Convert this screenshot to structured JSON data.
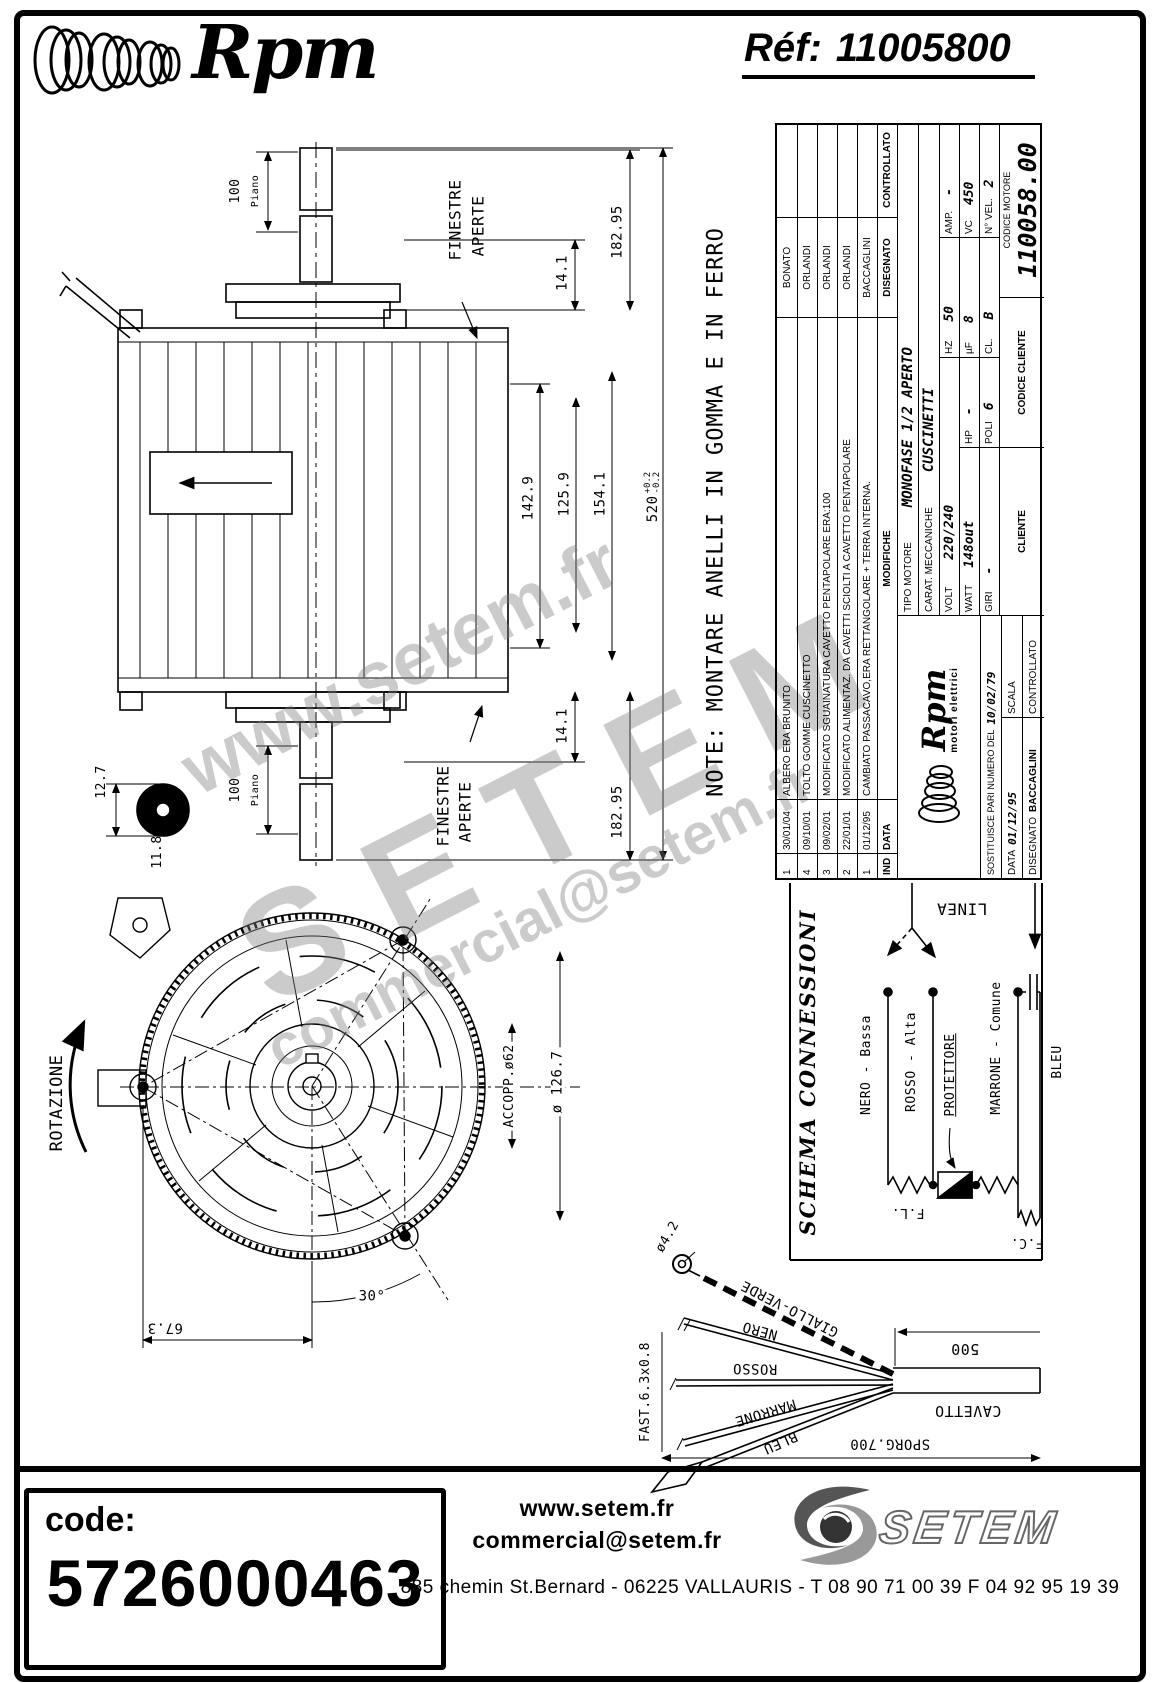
{
  "colors": {
    "ink": "#000000",
    "paper": "#ffffff",
    "watermark": "#7d7d7d"
  },
  "header": {
    "brand": "Rpm",
    "ref_label": "Réf:",
    "ref_number": "11005800"
  },
  "note": "NOTE: MONTARE ANELLI IN GOMMA E IN FERRO",
  "side_view": {
    "dim_100_top": "100",
    "piano_top": "Piano",
    "finestre_top_line1": "FINESTRE",
    "finestre_top_line2": "APERTE",
    "dim_14_1_top": "14.1",
    "dim_182_95_top": "182.95",
    "dim_142_9": "142.9",
    "dim_125_9": "125.9",
    "dim_154_1": "154.1",
    "dim_520": "520",
    "dim_520_tol_plus": "+0.2",
    "dim_520_tol_minus": "-0.2",
    "dim_14_1_bottom": "14.1",
    "dim_182_95_bottom": "182.95",
    "finestre_bottom_line1": "FINESTRE",
    "finestre_bottom_line2": "APERTE",
    "dim_100_bottom": "100",
    "piano_bottom": "Piano",
    "dim_12_7": "12.7",
    "dim_11_8": "11.8"
  },
  "front_view": {
    "rotazione": "ROTAZIONE",
    "accopp": "ACCOPP.ø62",
    "dia_126_7": "ø 126.7",
    "angle_30": "30°",
    "dim_67_3": "67.3"
  },
  "title_block": {
    "revisions": [
      {
        "ind": "1",
        "date": "30/01/04",
        "text": "ALBERO ERA BRUNITO",
        "name": "BONATO"
      },
      {
        "ind": "4",
        "date": "09/10/01",
        "text": "TOLTO GOMME CUSCINETTO",
        "name": "ORLANDI"
      },
      {
        "ind": "3",
        "date": "09/02/01",
        "text": "MODIFICATO SGUAINATURA CAVETTO PENTAPOLARE ERA:100",
        "name": "ORLANDI"
      },
      {
        "ind": "2",
        "date": "22/01/01",
        "text": "MODIFICATO ALIMENTAZ. DA CAVETTI SCIOLTI A CAVETTO PENTAPOLARE",
        "name": "ORLANDI"
      },
      {
        "ind": "1",
        "date": "01/12/95",
        "text": "CAMBIATO PASSACAVO,ERA RETTANGOLARE + TERRA INTERNA.",
        "name": "BACCAGLINI"
      }
    ],
    "rev_headers": {
      "ind": "IND",
      "data": "DATA",
      "modifiche": "MODIFICHE",
      "disegnato": "DISEGNATO",
      "controllato": "CONTROLLATO"
    },
    "tipo_motore_label": "TIPO MOTORE",
    "tipo_motore": "MONOFASE 1/2 APERTO",
    "carat_label": "CARAT. MECCANICHE",
    "carat": "CUSCINETTI",
    "specs": {
      "volt_label": "VOLT",
      "volt": "220/240",
      "hz_label": "HZ",
      "hz": "50",
      "amp_label": "AMP.",
      "amp": "-",
      "watt_label": "WATT",
      "watt": "148out",
      "hp_label": "HP",
      "hp": "-",
      "uf_label": "µF",
      "uf": "8",
      "vc_label": "VC",
      "vc": "450",
      "giri_label": "GIRI",
      "giri": "-",
      "poli_label": "POLI",
      "poli": "6",
      "cl_label": "CL.",
      "cl": "B",
      "nvel_label": "N° VEL.",
      "nvel": "2"
    },
    "logo_brand": "Rpm",
    "logo_sub": "motori elettrici",
    "sostituisce_label": "SOSTITUISCE PARI NUMERO DEL",
    "sostituisce_value": "10/02/79",
    "scala_label": "SCALA",
    "data_label": "DATA",
    "data_value": "01/12/95",
    "disegnato_label": "DISEGNATO",
    "disegnato_value": "BACCAGLINI",
    "controllato_label": "CONTROLLATO",
    "cliente_label": "CLIENTE",
    "codice_cliente_label": "CODICE CLIENTE",
    "codice_motore_label": "CODICE MOTORE",
    "codice_motore": "110058.00"
  },
  "schema": {
    "title": "SCHEMA CONNESSIONI",
    "linea": "LINEA",
    "nero": "NERO - Bassa",
    "rosso": "ROSSO - Alta",
    "marrone": "MARRONE - Comune",
    "protettore": "PROTETTORE",
    "bleu": "BLEU",
    "fl": "F.L.",
    "fc": "F.C."
  },
  "cable": {
    "dia_4_2": "ø4.2",
    "giallo_verde": "GIALLO-VERDE",
    "nero": "NERO",
    "rosso": "ROSSO",
    "marrone": "MARRONE",
    "bleu": "BLEU",
    "fast": "FAST.6.3x0.8",
    "dim_500": "500",
    "cavetto": "CAVETTO",
    "sporg": "SPORG.700"
  },
  "watermark": {
    "line1": "www.setem.fr",
    "line2": "SETEM",
    "line3": "commercial@setem.fr"
  },
  "footer": {
    "code_label": "code:",
    "code": "5726000463",
    "website": "www.setem.fr",
    "email": "commercial@setem.fr",
    "brand": "SETEM",
    "address": "885 chemin St.Bernard  -  06225 VALLAURIS  -  T 08 90 71 00 39   F 04 92 95 19 39"
  }
}
